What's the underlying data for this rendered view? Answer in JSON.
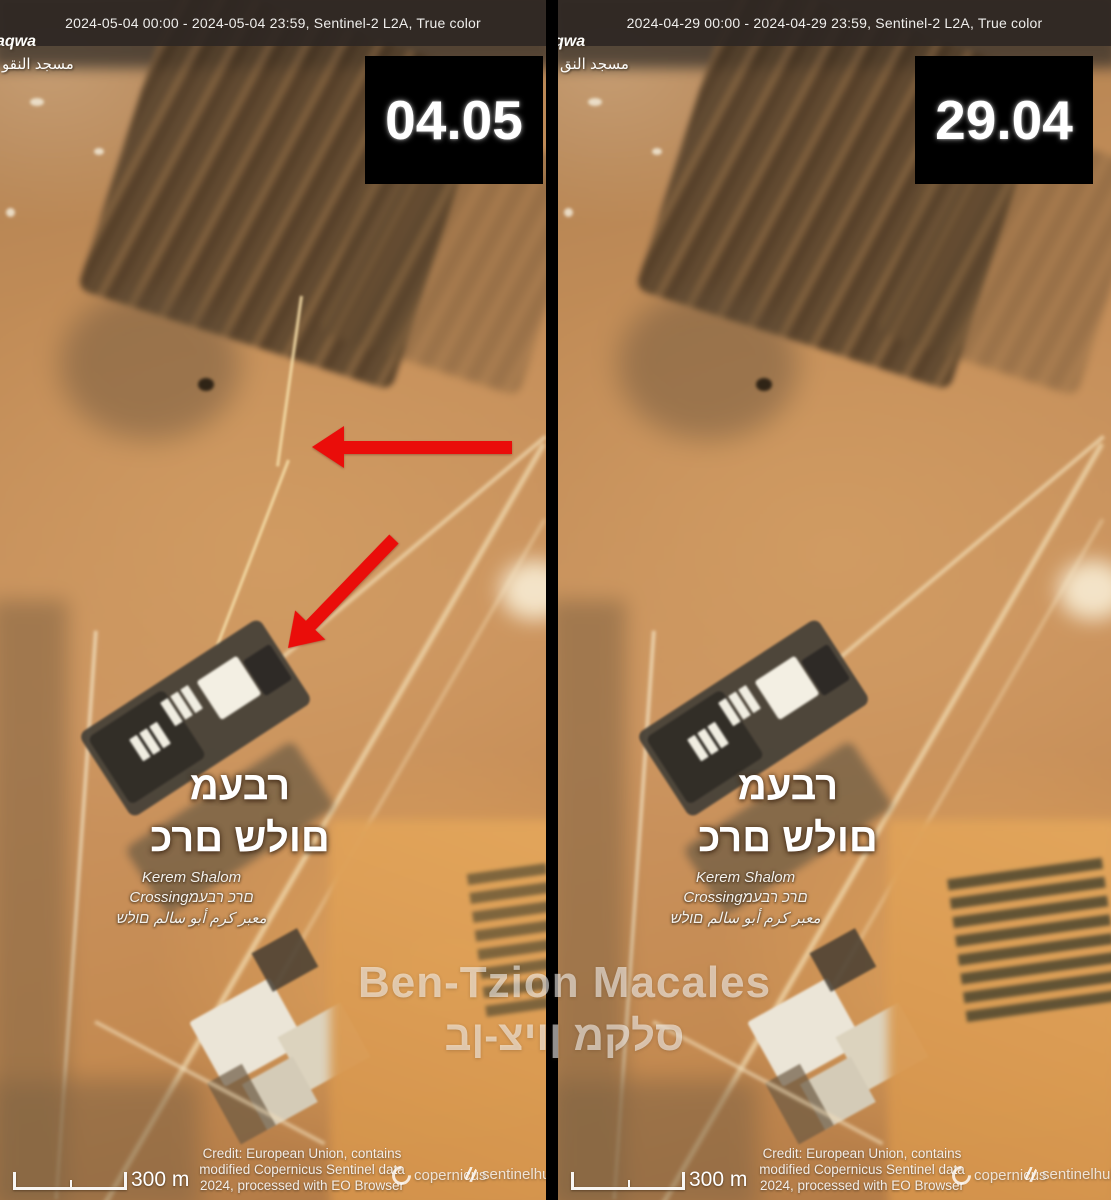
{
  "panels": [
    {
      "name": "left",
      "timespan": "2024-05-04 00:00 - 2024-05-04 23:59, Sentinel-2 L2A, True color",
      "date_badge": "04.05",
      "corner_latin": "aqwa",
      "corner_arabic": [
        "مسجد",
        "النقو"
      ]
    },
    {
      "name": "right",
      "timespan": "2024-04-29 00:00 - 2024-04-29 23:59, Sentinel-2 L2A, True color",
      "date_badge": "29.04",
      "corner_latin": "qwa",
      "corner_arabic": [
        "مسجد",
        "النق"
      ]
    }
  ],
  "crossing": {
    "big1": "מעבר",
    "big2": "כרם שלום",
    "small1": "Kerem Shalom",
    "small2": "Crossingמעבר כרם",
    "small3_he": "שלום",
    "small3_ar": [
      "معبر",
      "كرم",
      "أبو",
      "سالم"
    ]
  },
  "scale": {
    "label": "300 m"
  },
  "credit": {
    "line1": "Credit: European Union, contains",
    "line2": "modified Copernicus Sentinel data",
    "line3": "2024, processed with EO Browser"
  },
  "logos": {
    "copernicus": "copernicus",
    "sentinelhub": "sentinelhub"
  },
  "watermark": {
    "latin": "Ben-Tzion Macales",
    "hebrew": "בן-ציון מקלס"
  },
  "colors": {
    "arrow": "#ea0d0a",
    "badge_bg": "#000000",
    "badge_fg": "#ffffff",
    "divider": "#000000"
  }
}
